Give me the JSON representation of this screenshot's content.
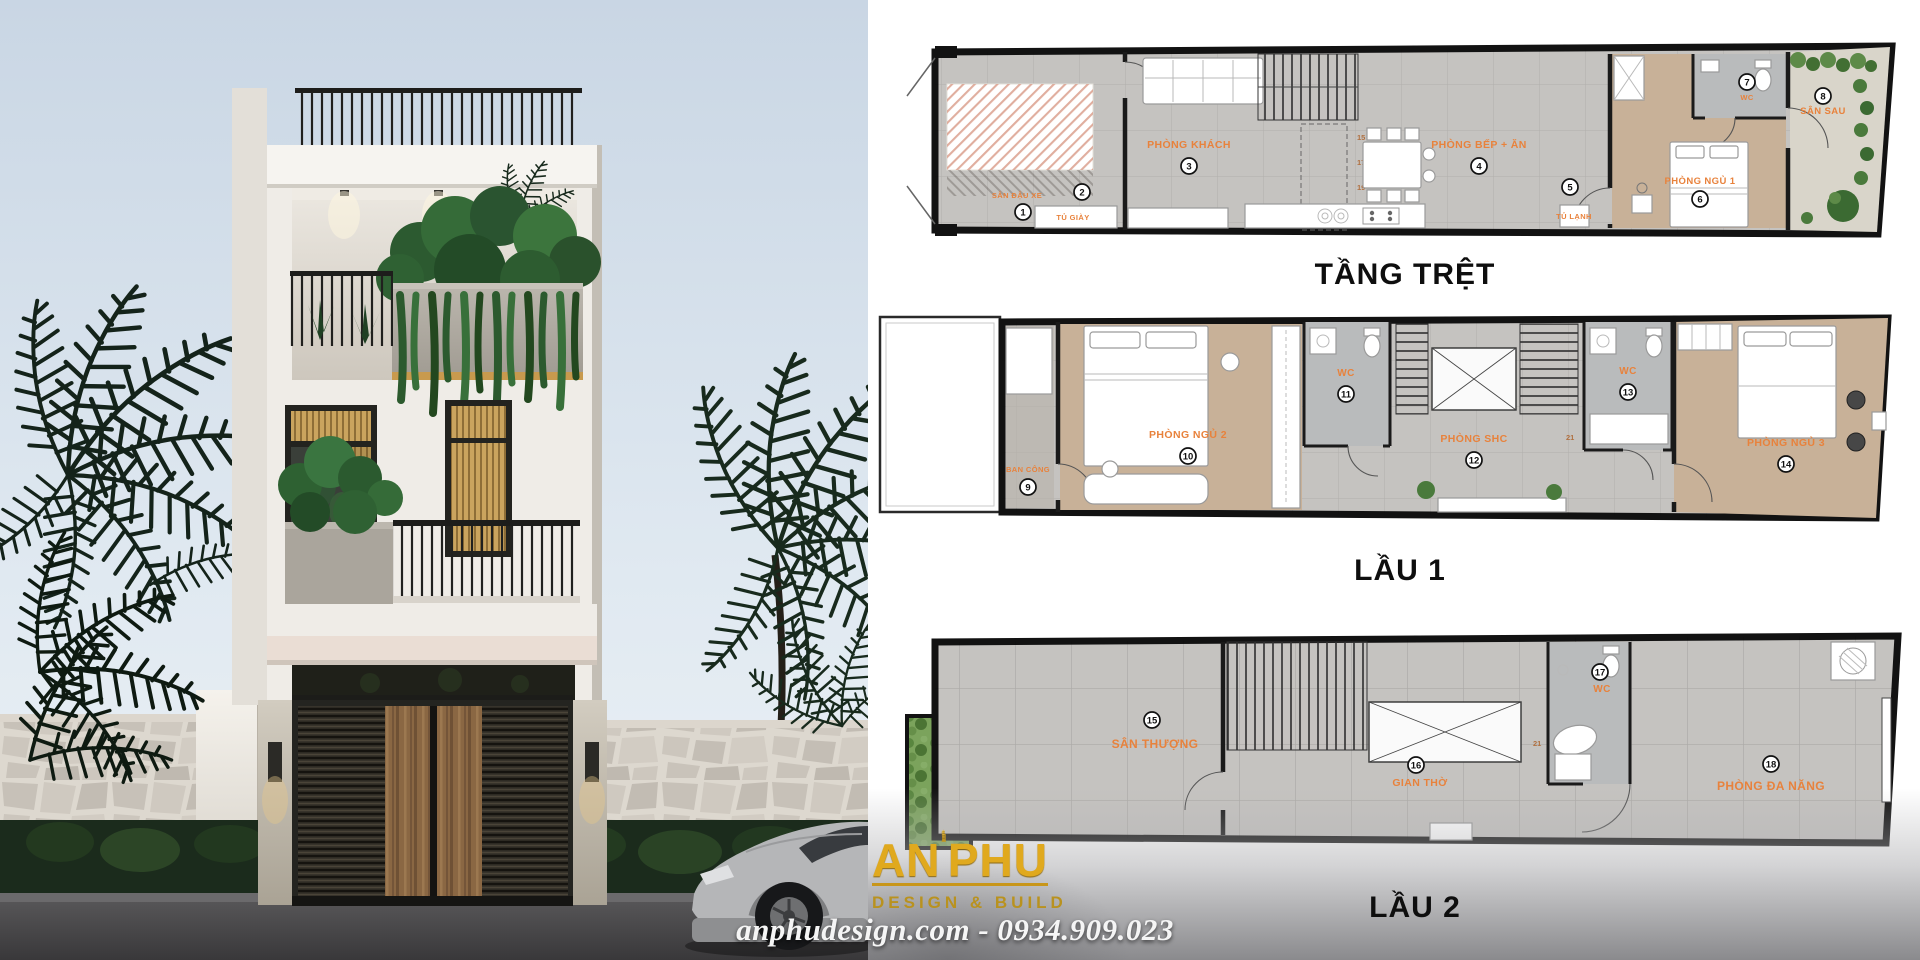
{
  "branding": {
    "logo_text_1": "AN",
    "logo_text_2": "PHU",
    "logo_tagline": "DESIGN & BUILD",
    "contact_line": "anphudesign.com - 0934.909.023",
    "logo_gold": "#d9a81f",
    "label_orange": "#e8823c",
    "wall_black": "#121212"
  },
  "plans": [
    {
      "title": "TẦNG TRỆT",
      "rooms": [
        {
          "num": "1",
          "label": "SÂN ĐẬU XE"
        },
        {
          "num": "2",
          "label": "TỦ GIÀY"
        },
        {
          "num": "3",
          "label": "PHÒNG KHÁCH"
        },
        {
          "num": "4",
          "label": "PHÒNG BẾP + ĂN"
        },
        {
          "num": "5",
          "label": "TỦ LẠNH"
        },
        {
          "num": "6",
          "label": "PHÒNG NGỦ 1"
        },
        {
          "num": "7",
          "label": "WC"
        },
        {
          "num": "8",
          "label": "SÂN SAU"
        }
      ],
      "stair_numbers": [
        "15",
        "17",
        "19",
        "21"
      ]
    },
    {
      "title": "LẦU 1",
      "rooms": [
        {
          "num": "9",
          "label": "BAN CÔNG"
        },
        {
          "num": "10",
          "label": "PHÒNG NGỦ 2"
        },
        {
          "num": "11",
          "label": "WC"
        },
        {
          "num": "12",
          "label": "PHÒNG SHC"
        },
        {
          "num": "13",
          "label": "WC"
        },
        {
          "num": "14",
          "label": "PHÒNG NGỦ 3"
        }
      ],
      "stair_numbers": [
        "21"
      ]
    },
    {
      "title": "LẦU 2",
      "rooms": [
        {
          "num": "15",
          "label": "SÂN THƯỢNG"
        },
        {
          "num": "16",
          "label": "GIAN THỜ"
        },
        {
          "num": "17",
          "label": "WC"
        },
        {
          "num": "18",
          "label": "PHÒNG ĐA NĂNG"
        }
      ],
      "stair_numbers": [
        "21"
      ]
    }
  ]
}
